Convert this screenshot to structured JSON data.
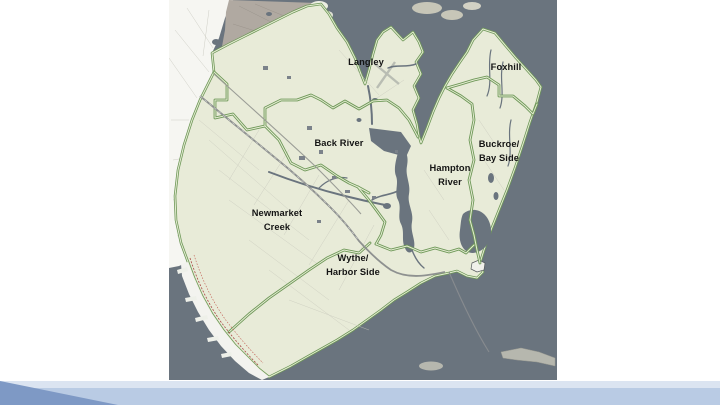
{
  "slide": {
    "background_color": "#ffffff",
    "footer": {
      "strip_color": "#dbe4f1",
      "bar_color": "#b9cbe4",
      "triangle_color": "#7e99c5"
    }
  },
  "map": {
    "description": "Watershed map of Hampton, Virginia with green watershed boundaries",
    "colors": {
      "water": "#6a747e",
      "city_land": "#e8ebd8",
      "outside_land": "#f6f6f2",
      "north_land": "#b0a9a1",
      "beach_strip": "#f3f3ef",
      "watershed_boundary_green": "#6e9858",
      "boundary_inner_pale": "#e6ecd4",
      "railroad_red": "#a84a44"
    },
    "regions": [
      {
        "name": "Langley",
        "lines": [
          "Langley"
        ]
      },
      {
        "name": "Foxhill",
        "lines": [
          "Foxhill"
        ]
      },
      {
        "name": "Back River",
        "lines": [
          "Back River"
        ]
      },
      {
        "name": "Buckroe/Bay Side",
        "lines": [
          "Buckroe/",
          "Bay Side"
        ]
      },
      {
        "name": "Hampton River",
        "lines": [
          "Hampton",
          "River"
        ]
      },
      {
        "name": "Newmarket Creek",
        "lines": [
          "Newmarket",
          "Creek"
        ]
      },
      {
        "name": "Wythe/Harbor Side",
        "lines": [
          "Wythe/",
          "Harbor Side"
        ]
      }
    ]
  }
}
